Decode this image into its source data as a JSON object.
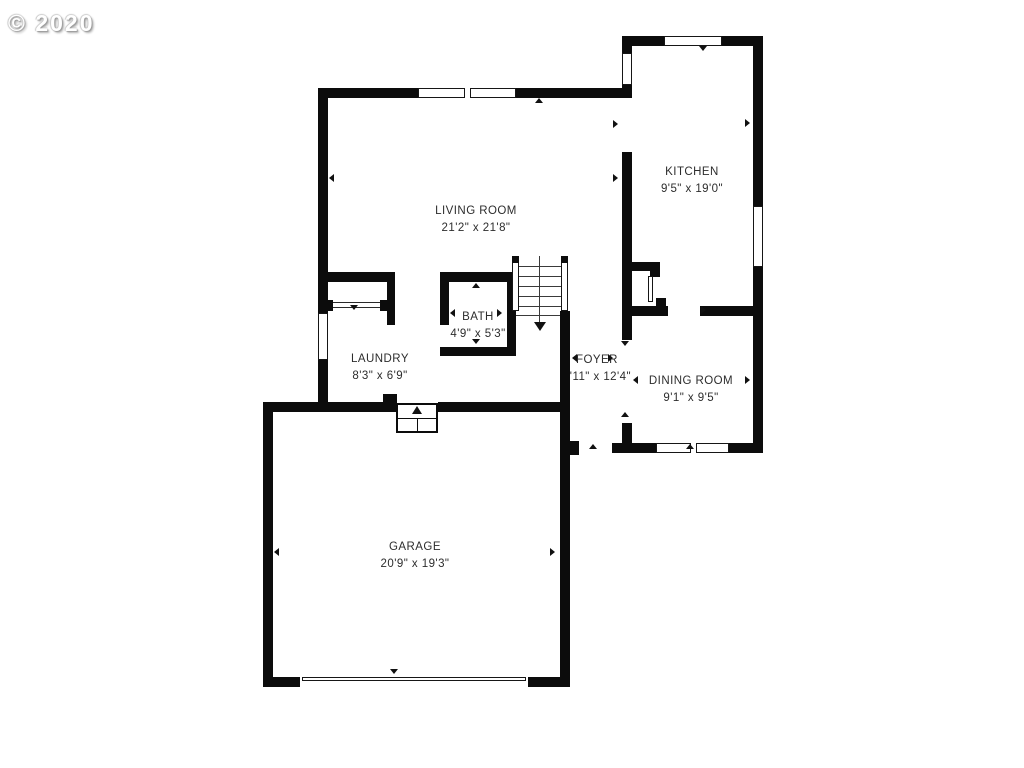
{
  "watermark": {
    "text": "© 2020"
  },
  "plan": {
    "title": "first-floor-plan",
    "rooms": [
      {
        "id": "kitchen",
        "name": "KITCHEN",
        "dimensions": "9'5\" x 19'0\""
      },
      {
        "id": "living-room",
        "name": "LIVING ROOM",
        "dimensions": "21'2\" x 21'8\""
      },
      {
        "id": "bath",
        "name": "BATH",
        "dimensions": "4'9\" x 5'3\""
      },
      {
        "id": "laundry",
        "name": "LAUNDRY",
        "dimensions": "8'3\" x 6'9\""
      },
      {
        "id": "foyer",
        "name": "FOYER",
        "dimensions": "8'11\" x 12'4\""
      },
      {
        "id": "dining-room",
        "name": "DINING ROOM",
        "dimensions": "9'1\" x 9'5\""
      },
      {
        "id": "garage",
        "name": "GARAGE",
        "dimensions": "20'9\" x 19'3\""
      }
    ],
    "stairs": {
      "arrow": "down"
    },
    "garage_steps": {
      "arrow": "up"
    }
  },
  "colors": {
    "wall": "#0c0c0c",
    "background": "#ffffff",
    "label_text": "#2d2d2d",
    "watermark_text": "#ffffff",
    "watermark_shadow": "#9a9a9a"
  }
}
